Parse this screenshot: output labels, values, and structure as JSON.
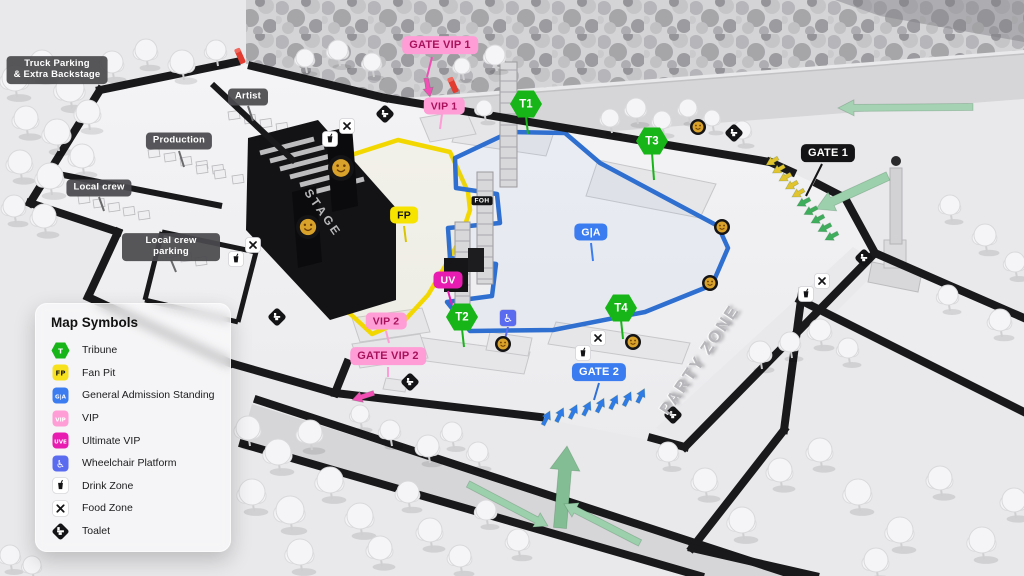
{
  "map_title": "Festival venue map",
  "legend": {
    "title": "Map Symbols",
    "items": [
      {
        "id": "tribune",
        "label": "Tribune",
        "badge": "T",
        "shape": "hexagon",
        "bg": "#17B517",
        "fg": "#ffffff"
      },
      {
        "id": "fan-pit",
        "label": "Fan Pit",
        "badge": "FP",
        "shape": "square",
        "bg": "#F7E11C",
        "fg": "#1a1a1a"
      },
      {
        "id": "general-admission",
        "label": "General Admission Standing",
        "badge": "G|A",
        "shape": "square",
        "bg": "#3B7DF0",
        "fg": "#ffffff"
      },
      {
        "id": "vip",
        "label": "VIP",
        "badge": "VIP",
        "shape": "square",
        "bg": "#FF9DD6",
        "fg": "#ffffff"
      },
      {
        "id": "ultimate-vip",
        "label": "Ultimate VIP",
        "badge": "UVE",
        "shape": "square",
        "bg": "#E81CB0",
        "fg": "#ffffff"
      },
      {
        "id": "wheelchair-platform",
        "label": "Wheelchair Platform",
        "badge": "♿",
        "shape": "square",
        "bg": "#5A6BF0",
        "fg": "#ffffff",
        "icon": "wheelchair-icon"
      },
      {
        "id": "drink-zone",
        "label": "Drink Zone",
        "shape": "square",
        "bg": "#ffffff",
        "fg": "#111111",
        "icon": "drink-icon"
      },
      {
        "id": "food-zone",
        "label": "Food Zone",
        "shape": "square",
        "bg": "#ffffff",
        "fg": "#111111",
        "icon": "food-icon"
      },
      {
        "id": "toilet",
        "label": "Toalet",
        "shape": "diamond",
        "bg": "#141416",
        "fg": "#ffffff",
        "icon": "toilet-icon"
      }
    ]
  },
  "map_labels": {
    "gate_vip_1": "GATE VIP 1",
    "vip_1": "VIP 1",
    "vip_2": "VIP 2",
    "gate_vip_2": "GATE VIP 2",
    "gate_1": "GATE 1",
    "gate_2": "GATE 2",
    "t1": "T1",
    "t2": "T2",
    "t3": "T3",
    "t4": "T4",
    "fp": "FP",
    "ga": "G|A",
    "uv": "UV",
    "foh": "FOH",
    "stage": "STAGE",
    "party_zone": "PARTY ZONE",
    "truck_parking": "Truck Parking\n& Extra Backstage",
    "artist": "Artist",
    "production": "Production",
    "local_crew": "Local crew",
    "local_crew_parking": "Local crew parking"
  },
  "map_icons": [
    "smiley-logo-icon",
    "drink-zone-icon",
    "food-zone-icon",
    "toilet-icon",
    "wheelchair-icon",
    "red-flag-marker",
    "direction-arrow"
  ],
  "colors": {
    "tribune_green": "#17B517",
    "fanpit_yellow": "#F2D800",
    "ga_blue": "#2E6FD0",
    "vip_pink": "#FF9DD6",
    "ultimate_magenta": "#E81CB0",
    "wheelchair_blue": "#5A6BF0",
    "gate2_blue": "#2E7BE8",
    "arrow_green_light": "#A5D2B2",
    "arrow_green": "#3FAE5C",
    "arrow_yellow": "#E2C42E",
    "arrow_pink": "#F24FB5",
    "wall_black": "#19191b",
    "smiley_gold": "#D9A22A",
    "label_dark": "#4a4a4d"
  }
}
